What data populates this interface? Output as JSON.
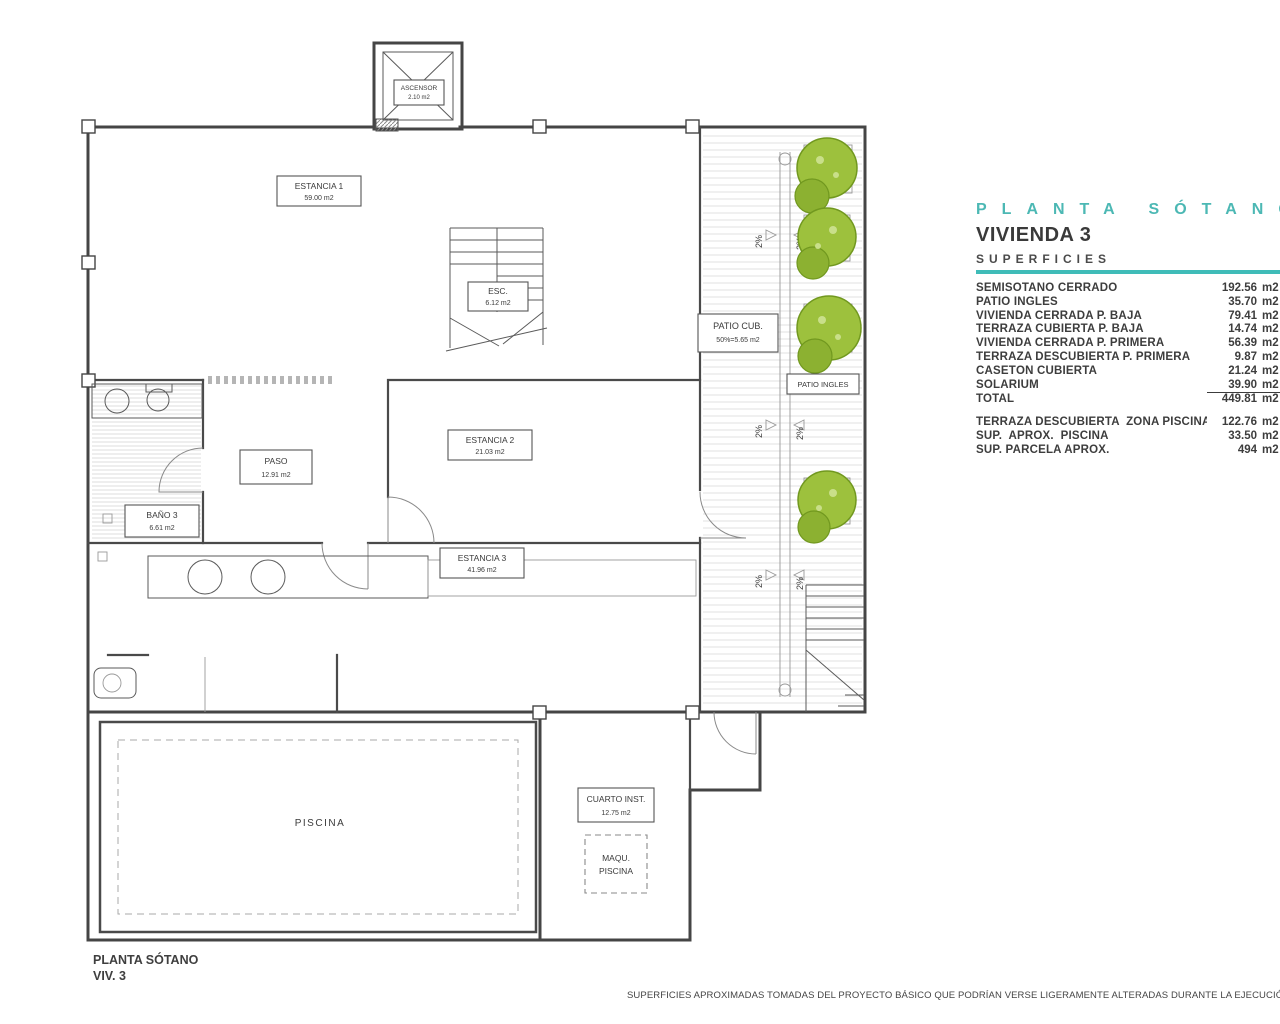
{
  "header": {
    "plan_title": "PLANTA SÓTANO",
    "unit_title": "VIVIENDA 3",
    "section_title": "SUPERFICIES"
  },
  "areas_table": {
    "rows": [
      {
        "label": "SEMISÓTANO CERRADO",
        "value": "192.56",
        "unit": "m2"
      },
      {
        "label": "PATIO INGLÉS",
        "value": "35.70",
        "unit": "m2"
      },
      {
        "label": "VIVIENDA CERRADA P. BAJA",
        "value": "79.41",
        "unit": "m2"
      },
      {
        "label": "TERRAZA CUBIERTA P. BAJA",
        "value": "14.74",
        "unit": "m2"
      },
      {
        "label": "VIVIENDA CERRADA P. PRIMERA",
        "value": "56.39",
        "unit": "m2"
      },
      {
        "label": "TERRAZA DESCUBIERTA P. PRIMERA",
        "value": "9.87",
        "unit": "m2"
      },
      {
        "label": "CASETÓN CUBIERTA",
        "value": "21.24",
        "unit": "m2"
      },
      {
        "label": "SOLARIUM",
        "value": "39.90",
        "unit": "m2"
      },
      {
        "label": "TOTAL",
        "value": "449.81",
        "unit": "m2"
      }
    ],
    "extra_rows": [
      {
        "label": "TERRAZA DESCUBIERTA  ZONA PISCINA",
        "value": "122.76",
        "unit": "m2"
      },
      {
        "label": "SUP.  APROX.  PISCINA",
        "value": "33.50",
        "unit": "m2"
      },
      {
        "label": "SUP. PARCELA APROX.",
        "value": "494",
        "unit": "m2"
      }
    ]
  },
  "plan": {
    "slope_label": "2%",
    "rooms": {
      "ascensor": {
        "name": "ASCENSOR",
        "area": "2.10 m2"
      },
      "estancia1": {
        "name": "ESTANCIA 1",
        "area": "59.00 m2"
      },
      "esc": {
        "name": "ESC.",
        "area": "6.12 m2"
      },
      "patio_cub": {
        "name": "PATIO CUB.",
        "area": "50%=5.65 m2"
      },
      "patio_ingles": {
        "name": "PATIO INGLES"
      },
      "paso": {
        "name": "PASO",
        "area": "12.91 m2"
      },
      "estancia2": {
        "name": "ESTANCIA 2",
        "area": "21.03 m2"
      },
      "bano3": {
        "name": "BAÑO 3",
        "area": "6.61 m2"
      },
      "estancia3": {
        "name": "ESTANCIA 3",
        "area": "41.96 m2"
      },
      "piscina": {
        "name": "PISCINA"
      },
      "cuarto_inst": {
        "name": "CUARTO INST.",
        "area": "12.75 m2"
      },
      "maqu_piscina": {
        "name": "MAQU.",
        "name2": "PISCINA"
      }
    }
  },
  "footer": {
    "plan_name": "PLANTA SÓTANO",
    "unit_ref": "VIV. 3",
    "disclaimer": "SUPERFICIES APROXIMADAS TOMADAS DEL PROYECTO BÁSICO QUE PODRÍAN VERSE LIGERAMENTE ALTERADAS DURANTE LA EJECUCIÓN DE LAS OBRAS"
  },
  "colors": {
    "accent_teal": "#3fbcb8",
    "tree_green": "#9dc13d",
    "line": "#454545"
  }
}
